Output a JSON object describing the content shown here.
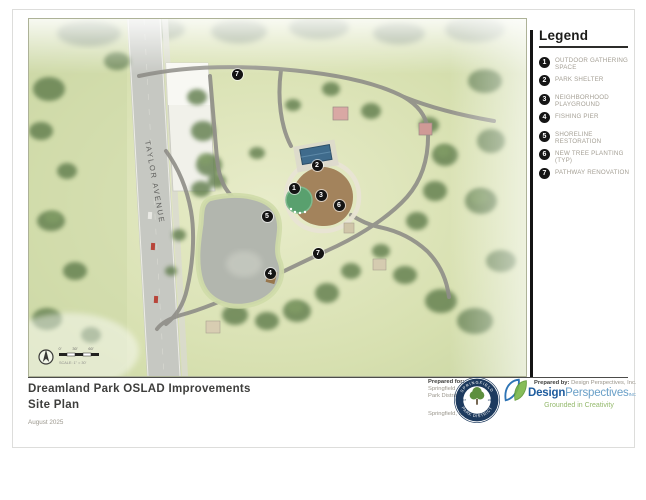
{
  "legend": {
    "title": "Legend",
    "items": [
      {
        "num": "1",
        "label": "OUTDOOR GATHERING SPACE"
      },
      {
        "num": "2",
        "label": "PARK SHELTER"
      },
      {
        "num": "3",
        "label": "NEIGHBORHOOD PLAYGROUND"
      },
      {
        "num": "4",
        "label": "FISHING PIER"
      },
      {
        "num": "5",
        "label": "SHORELINE RESTORATION"
      },
      {
        "num": "6",
        "label": "NEW TREE PLANTING (TYP)"
      },
      {
        "num": "7",
        "label": "PATHWAY RENOVATION"
      }
    ]
  },
  "map": {
    "street_label": "TAYLOR AVENUE",
    "markers": [
      {
        "num": "7",
        "x": 208,
        "y": 55
      },
      {
        "num": "2",
        "x": 288,
        "y": 146
      },
      {
        "num": "1",
        "x": 265,
        "y": 169
      },
      {
        "num": "3",
        "x": 292,
        "y": 176
      },
      {
        "num": "6",
        "x": 310,
        "y": 186
      },
      {
        "num": "5",
        "x": 238,
        "y": 197
      },
      {
        "num": "7",
        "x": 289,
        "y": 234
      },
      {
        "num": "4",
        "x": 241,
        "y": 254
      }
    ],
    "scale_labels": [
      "0'",
      "30'",
      "60'"
    ],
    "scale_note": "SCALE: 1\" = 30'"
  },
  "titleblock": {
    "title": "Dreamland Park OSLAD Improvements",
    "subtitle": "Site Plan",
    "date": "August 2025"
  },
  "prepared_for": {
    "heading": "Prepared for:",
    "line1": "Springfield",
    "line2": "Park District",
    "location": "Springfield, IL",
    "logo": {
      "top": "SPRINGFIELD",
      "bottom": "PARK DISTRICT",
      "est": "EST",
      "year": "1900"
    }
  },
  "prepared_by": {
    "heading": "Prepared by:",
    "name": "Design Perspectives, Inc.",
    "brand_bold": "Design",
    "brand_light": "Perspectives",
    "brand_suffix": "INC",
    "tagline": "Grounded in Creativity"
  },
  "colors": {
    "marker": "#141414",
    "playground": "#a3835c",
    "shelter_roof": "#3f6b8c",
    "pond": "#b2b6ae",
    "path": "#8f8e88",
    "brand_blue": "#1e5c9e",
    "brand_light_blue": "#6aa0c8",
    "brand_green": "#94b96c",
    "logo_navy": "#1d3a5e"
  }
}
